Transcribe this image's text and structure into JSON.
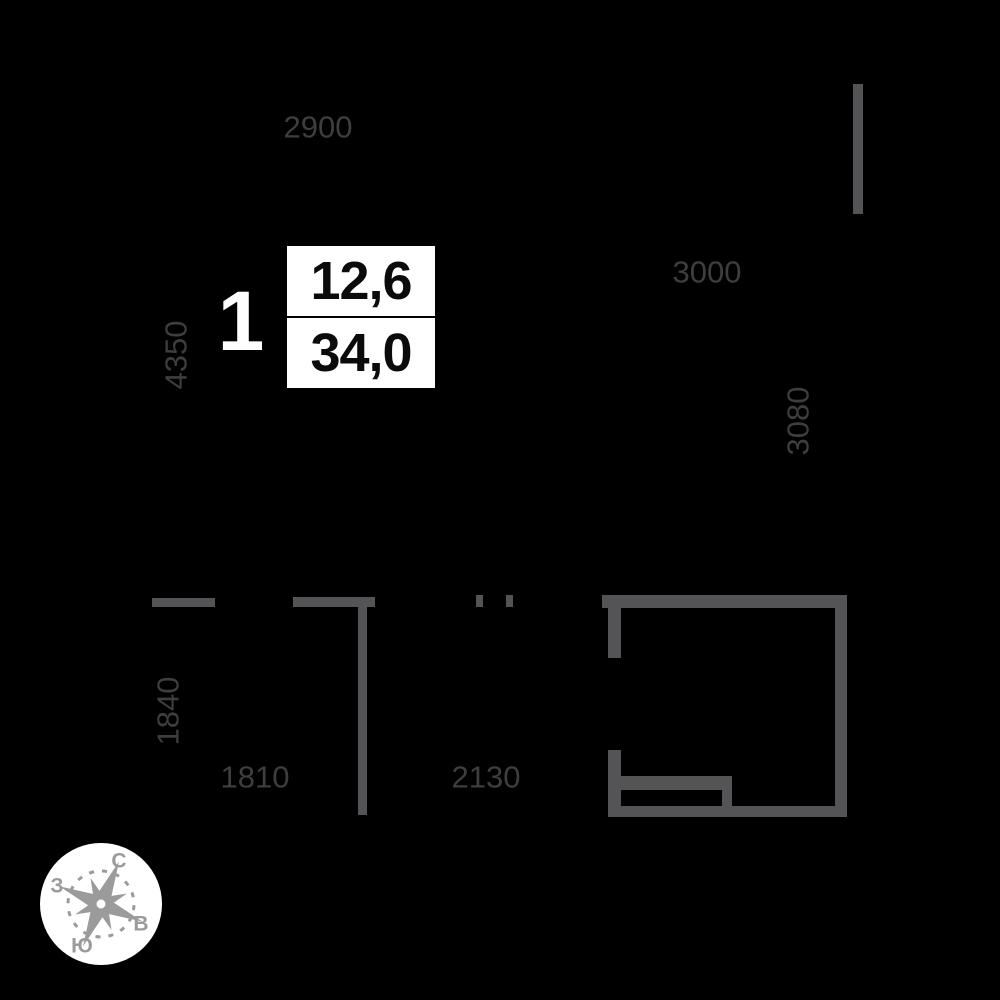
{
  "floorplan": {
    "unit_number": "1",
    "area_box": {
      "upper_value": "12,6",
      "lower_value": "34,0"
    },
    "dimensions": {
      "top_width": "2900",
      "left_height": "4350",
      "mid_width": "3000",
      "right_height": "3080",
      "lower_left_height": "1840",
      "lower_left_width": "1810",
      "lower_mid_width": "2130"
    },
    "compass": {
      "north": "С",
      "south": "Ю",
      "west": "З",
      "east": "В"
    },
    "colors": {
      "background": "#000000",
      "wall": "#545456",
      "dimension_text": "#3d3e40",
      "compass_gray": "#9b9b9b",
      "badge_background": "#ffffff",
      "badge_text": "#0b0b0b"
    }
  }
}
